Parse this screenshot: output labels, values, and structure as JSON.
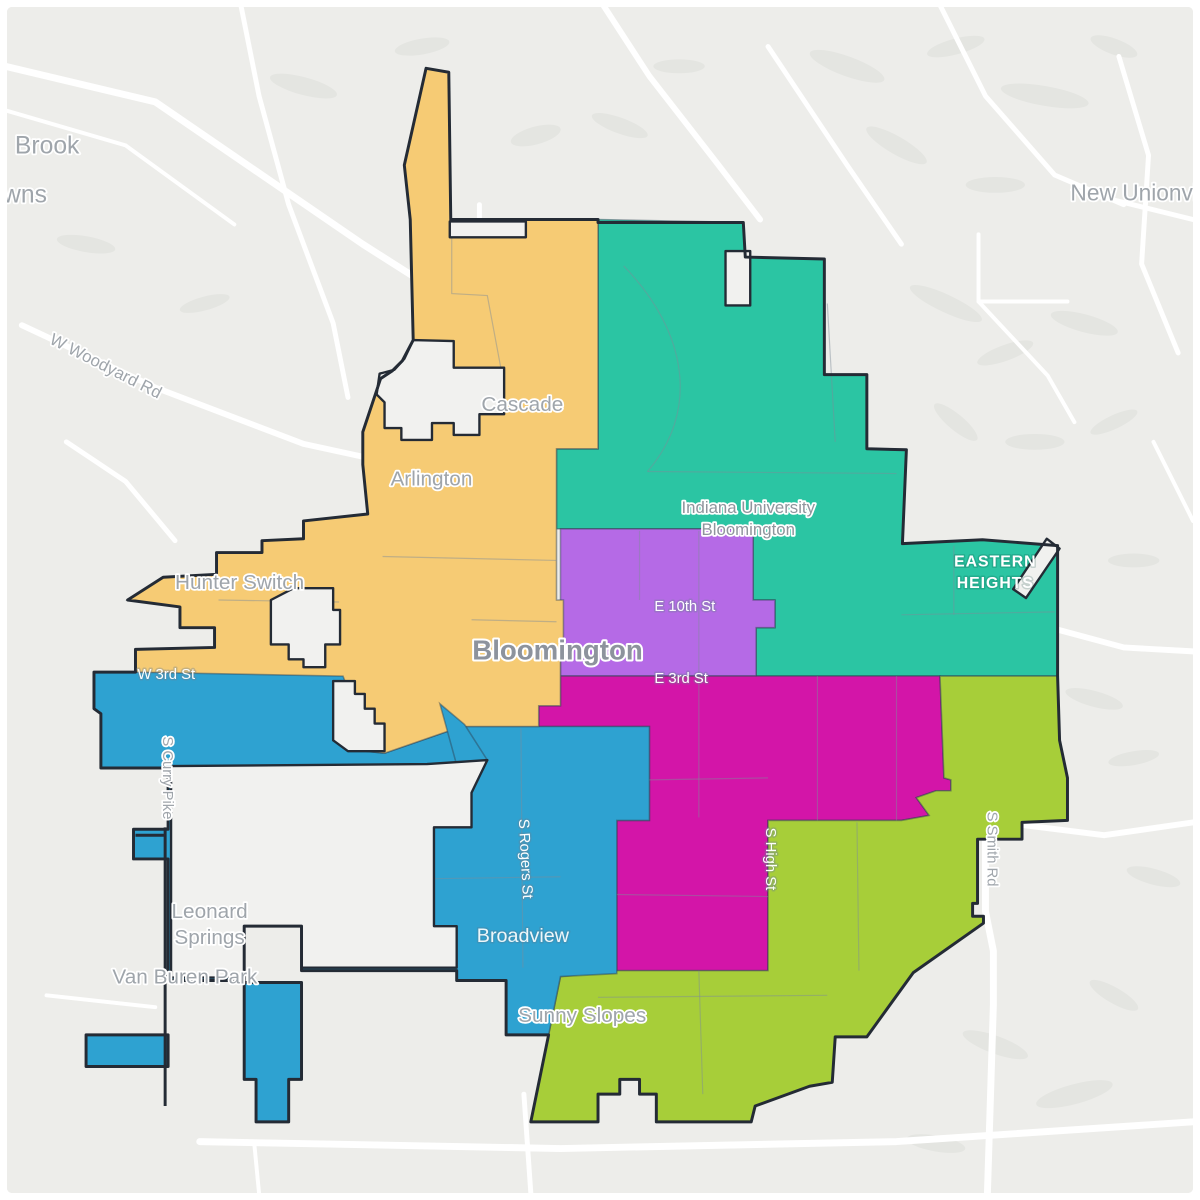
{
  "map": {
    "description": "City district map of Bloomington, Indiana with six colored council districts",
    "colors": {
      "district_orange": "#F6CB74",
      "district_teal": "#2BC5A3",
      "district_purple": "#B56AE6",
      "district_magenta": "#D315A8",
      "district_blue": "#2EA2D1",
      "district_lime": "#A7CE39",
      "land": "#EDEDEA",
      "road": "#FFFFFF",
      "city_boundary": "#242B35",
      "subline": "#7E8C9A",
      "water": "#C5CFD4",
      "hillshade": "#E4E5E1",
      "label_gray": "#9FA5AB",
      "label_dark": "#8D939D",
      "label_white": "#FFFFFF"
    },
    "districts": [
      {
        "id": "northwest",
        "color_key": "district_orange"
      },
      {
        "id": "northeast",
        "color_key": "district_teal"
      },
      {
        "id": "central",
        "color_key": "district_purple"
      },
      {
        "id": "south-central",
        "color_key": "district_magenta"
      },
      {
        "id": "southwest",
        "color_key": "district_blue"
      },
      {
        "id": "southeast",
        "color_key": "district_lime"
      }
    ],
    "place_labels": {
      "brook_line1": "Brook",
      "brook_line2": "wns",
      "new_unionville": "New Unionville",
      "w_woodyard_rd": "W Woodyard Rd",
      "cascade": "Cascade",
      "arlington": "Arlington",
      "hunter_switch": "Hunter Switch",
      "iu_line1": "Indiana University",
      "iu_line2": "Bloomington",
      "eastern_heights_line1": "EASTERN",
      "eastern_heights_line2": "HEIGHTS",
      "w_3rd_st": "W 3rd St",
      "bloomington_city": "Bloomington",
      "e_10th_st": "E 10th St",
      "e_3rd_st": "E 3rd St",
      "s_curry_pike": "S Curry Pike",
      "s_rogers_st": "S Rogers St",
      "s_high_st": "S High St",
      "s_smith_rd": "S Smith Rd",
      "leonard_springs_line1": "Leonard",
      "leonard_springs_line2": "Springs",
      "van_buren_park": "Van Buren Park",
      "broadview": "Broadview",
      "sunny_slopes": "Sunny Slopes"
    }
  }
}
